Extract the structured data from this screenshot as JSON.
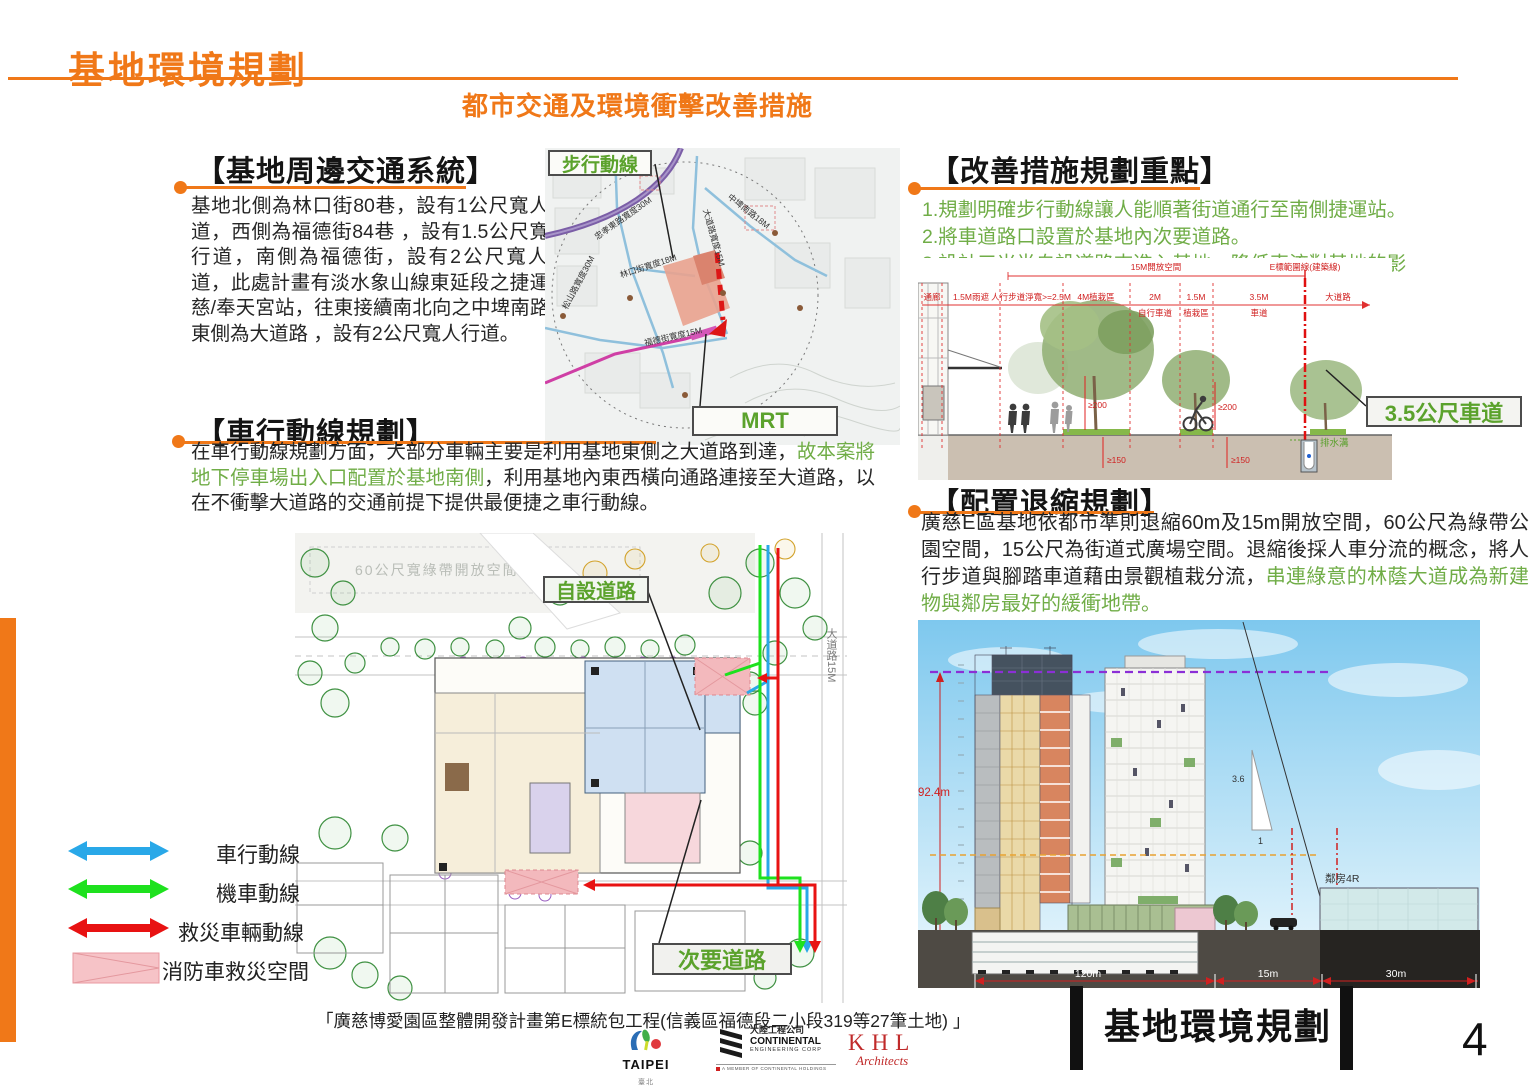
{
  "header": {
    "title": "基地環境規劃",
    "subtitle": "都市交通及環境衝擊改善措施"
  },
  "traffic": {
    "heading": "【基地周邊交通系統】",
    "body": "基地北側為林口街80巷，設有1公尺寬人行道，西側為福德街84巷 ，設有1.5公尺寬人行道，南側為福德街，設有2公尺寬人行道，此處計畫有淡水象山線東延段之捷運廣慈/奉天宮站，往東接續南北向之中埤南路，東側為大道路 ，設有2公尺寬人行道。"
  },
  "vehicle": {
    "heading": "【車行動線規劃】",
    "seg1": "在車行動線規劃方面，大部分車輛主要是利用基地東側之大道路到達，",
    "seg2": "故本案將地下停車場出入口配置於基地南側",
    "seg3": "，利用基地內東西橫向通路連接至大道路，以在不衝擊大道路的交通前提下提供最便捷之車行動線。"
  },
  "improvement": {
    "heading": "【改善措施規劃重點】",
    "item1": "1.規劃明確步行動線讓人能順著街道通行至南側捷運站。",
    "item2": "2.將車道路口設置於基地內次要道路。",
    "item3": "3.設計三米半自設道路來進入基地，降低車流對基地的影響。"
  },
  "setback": {
    "heading": "【配置退縮規劃】",
    "seg1": "廣慈E區基地依都市準則退縮60m及15m開放空間，60公尺為綠帶公園空間，15公尺為街道式廣場空間。退縮後採人車分流的概念，將人行步道與腳踏車道藉由景觀植栽分流，",
    "seg2": "串連綠意的林蔭大道成為新建物與鄰房最好的緩衝地帶。"
  },
  "map": {
    "walk_label": "步行動線",
    "mrt_label": "MRT",
    "streets": [
      "忠孝東路寬度30M",
      "中埤南路18M",
      "大道路寬度15M",
      "林口街寬度18M",
      "松山路寬度30M",
      "福德街寬度15M"
    ]
  },
  "siteplan": {
    "self_road_label": "自設道路",
    "secondary_road_label": "次要道路",
    "park_note": "60公尺寬綠帶開放空間",
    "street_right": "大道路15M"
  },
  "legend": {
    "car": "車行動線",
    "moto": "機車動線",
    "rescue": "救災車輛動線",
    "fire": "消防車救災空間"
  },
  "cross_section": {
    "open_space": "15M開放空間",
    "e_line": "E標範圍線(建築線)",
    "d1": "通廊",
    "d2": "1.5M雨遮",
    "d3": "人行步道淨寬>=2.5M",
    "d4": "4M植栽區",
    "d5a": "2M",
    "d5b": "自行車道",
    "d6a": "1.5M",
    "d6b": "植栽區",
    "d7a": "3.5M",
    "d7b": "車道",
    "d8": "大道路",
    "h200a": "≥200",
    "h200b": "≥200",
    "h150a": "≥150",
    "h150b": "≥150",
    "drain": "排水溝",
    "callout": "3.5公尺車道"
  },
  "elevation": {
    "height": "92.4m",
    "slope_v": "3.6",
    "slope_h": "1",
    "neighbor": "鄰房4R",
    "dim1": "120m",
    "dim2": "15m",
    "dim3": "30m",
    "caption": "基地環境規劃"
  },
  "footer": {
    "project": "「廣慈博愛園區整體開發計畫第E標統包工程(信義區福德段二小段319等27筆土地) 」",
    "taipei": "TAIPEI",
    "taipei_sub": "臺北",
    "cec_cn": "大陸工程公司",
    "cec_en": "CONTINENTAL",
    "cec_en2": "ENGINEERING CORP",
    "cec_member": "A MEMBER OF CONTINENTAL HOLDINGS",
    "khl": "KHL",
    "khl_sub": "Architects"
  },
  "page_number": "4"
}
